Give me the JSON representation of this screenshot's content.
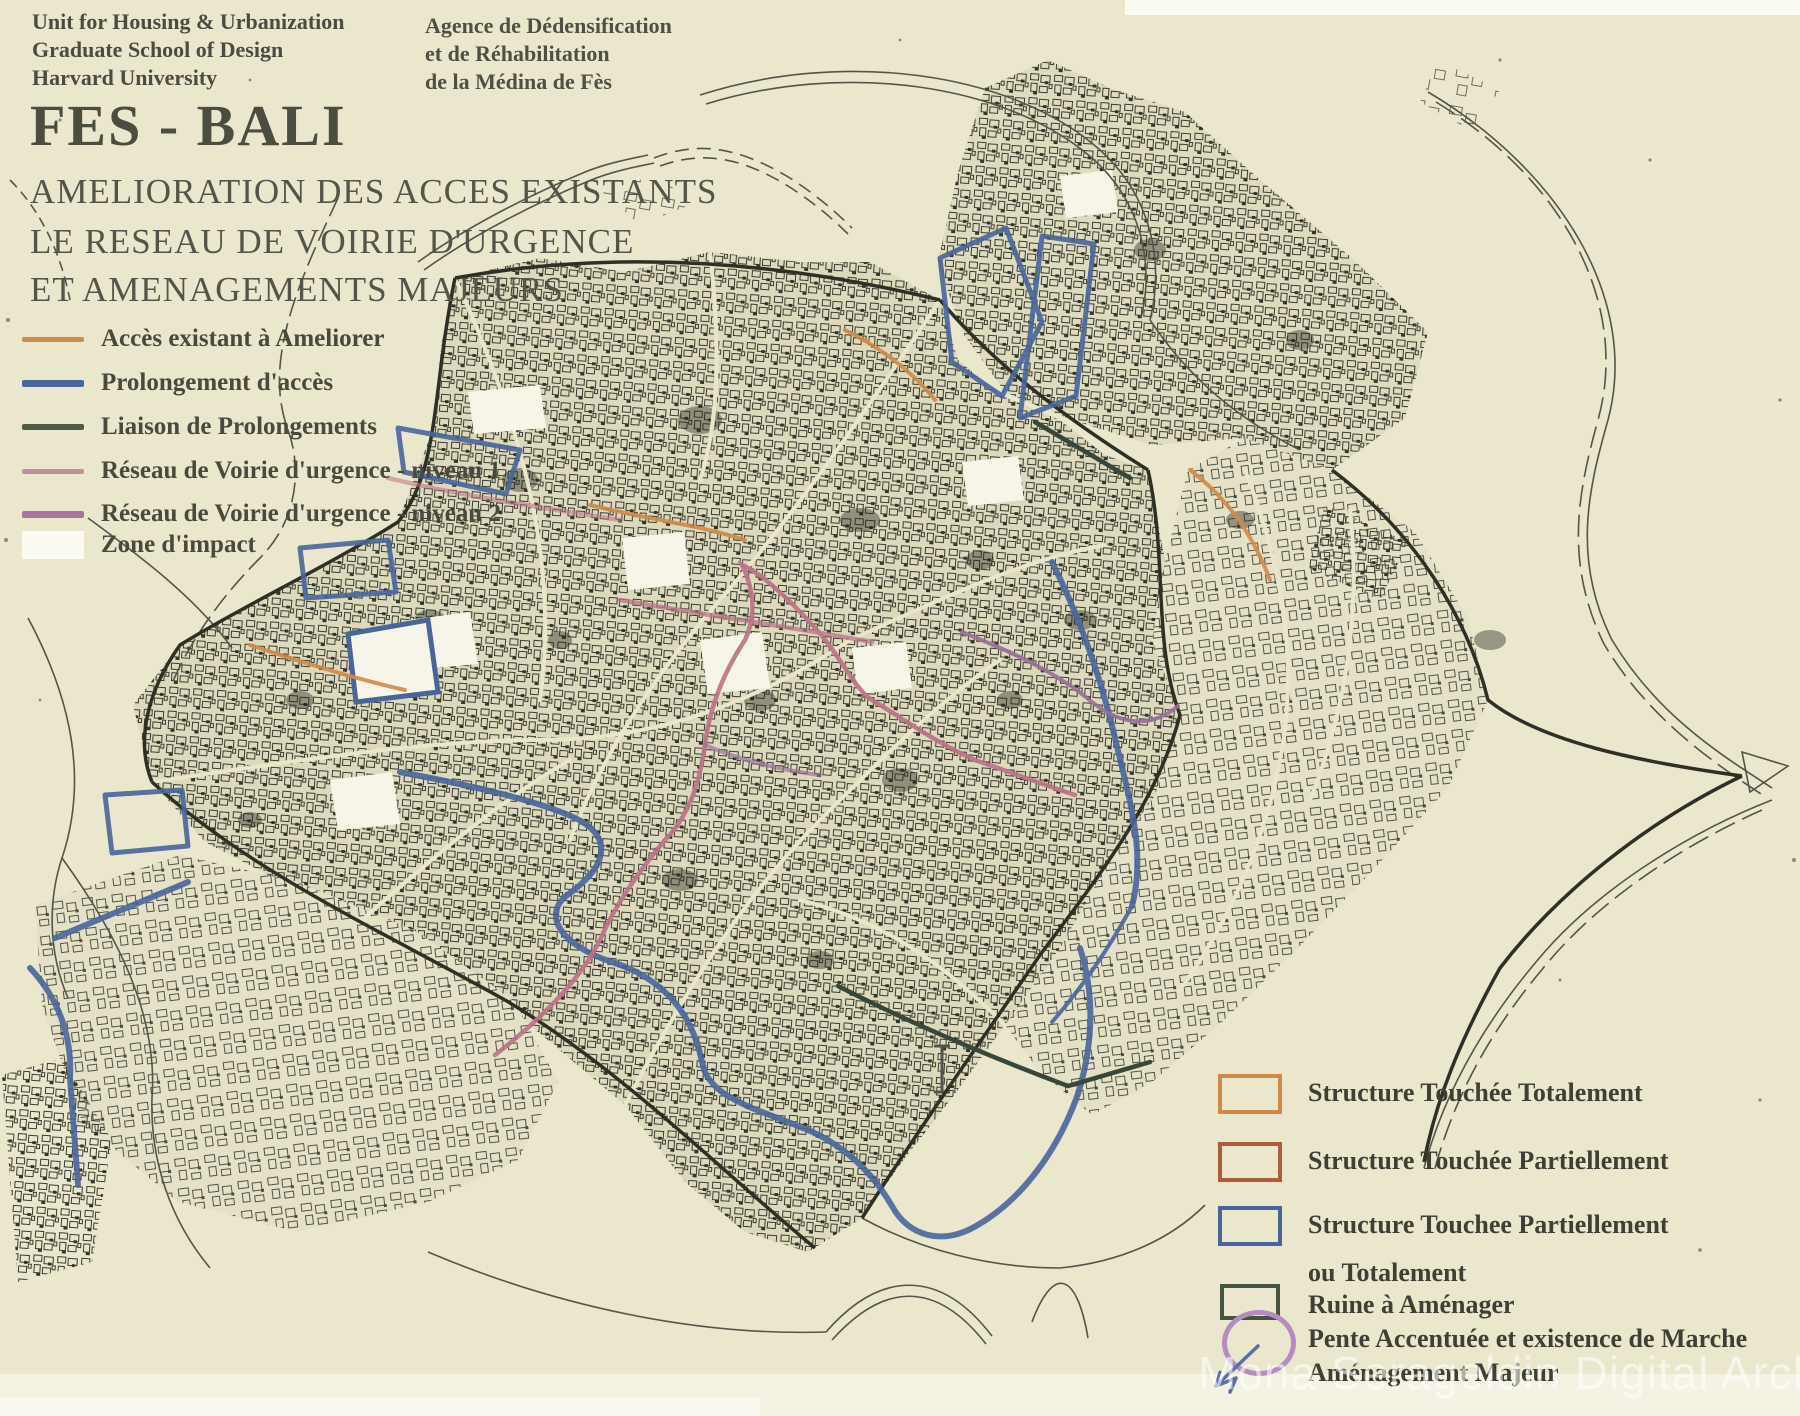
{
  "header": {
    "org_lines": [
      "Unit for Housing & Urbanization",
      "Graduate School of Design",
      "Harvard University"
    ],
    "agency_lines": [
      "Agence de Dédensification",
      "et de Réhabilitation",
      "de la Médina de Fès"
    ],
    "title": "FES - BALI",
    "subtitle_lines": [
      "AMELIORATION DES ACCES EXISTANTS",
      "LE RESEAU DE VOIRIE D'URGENCE",
      "ET AMENAGEMENTS MAJEURS"
    ]
  },
  "legend_access": {
    "items": [
      {
        "label": "Accès existant à Ameliorer",
        "swatch": "line",
        "color": "#d28a47"
      },
      {
        "label": "Prolongement d'accès",
        "swatch": "line",
        "color": "#48669c"
      },
      {
        "label": "Liaison de Prolongements",
        "swatch": "line",
        "color": "#4e5c48"
      },
      {
        "label": "Réseau de Voirie d'urgence - niveau 1",
        "swatch": "line",
        "color": "#c48ea0"
      },
      {
        "label": "Réseau de Voirie d'urgence - niveau 2",
        "swatch": "line",
        "color": "#a8739c"
      },
      {
        "label": "Zone d'impact",
        "swatch": "area",
        "color": "#ffffff"
      }
    ]
  },
  "legend_structures": {
    "items": [
      {
        "label": "Structure Touchée Totalement",
        "swatch": "rect",
        "color": "#cf8a45"
      },
      {
        "label": "Structure Touchée Partiellement",
        "swatch": "rect",
        "color": "#b25a3c"
      },
      {
        "label": "Structure Touchee Partiellement",
        "label2": "ou Totalement",
        "swatch": "rect",
        "color": "#47659c"
      },
      {
        "label": "Ruine à Aménager",
        "swatch": "rect",
        "color": "#44523f"
      },
      {
        "label": "Pente Accentuée et existence de Marche",
        "swatch": "ellipse",
        "color": "#b48cc0"
      },
      {
        "label": "Aménagement Majeur",
        "swatch": "arrow",
        "color": "#5a6fa8"
      }
    ]
  },
  "map": {
    "background_color": "#eae7cd",
    "fabric_ink_color": "#3a3c2f",
    "zone_impact_color": "#ffffff",
    "route_colors": {
      "acces_existant": "#d28a47",
      "prolongement_acces": "#48669c",
      "liaison_prolongements": "#39463a",
      "voirie_urgence_niveau_1": "#bd7287",
      "voirie_urgence_niveau_2": "#9a6e9a"
    }
  },
  "watermark": "Mona Serageldin Digital Archive"
}
